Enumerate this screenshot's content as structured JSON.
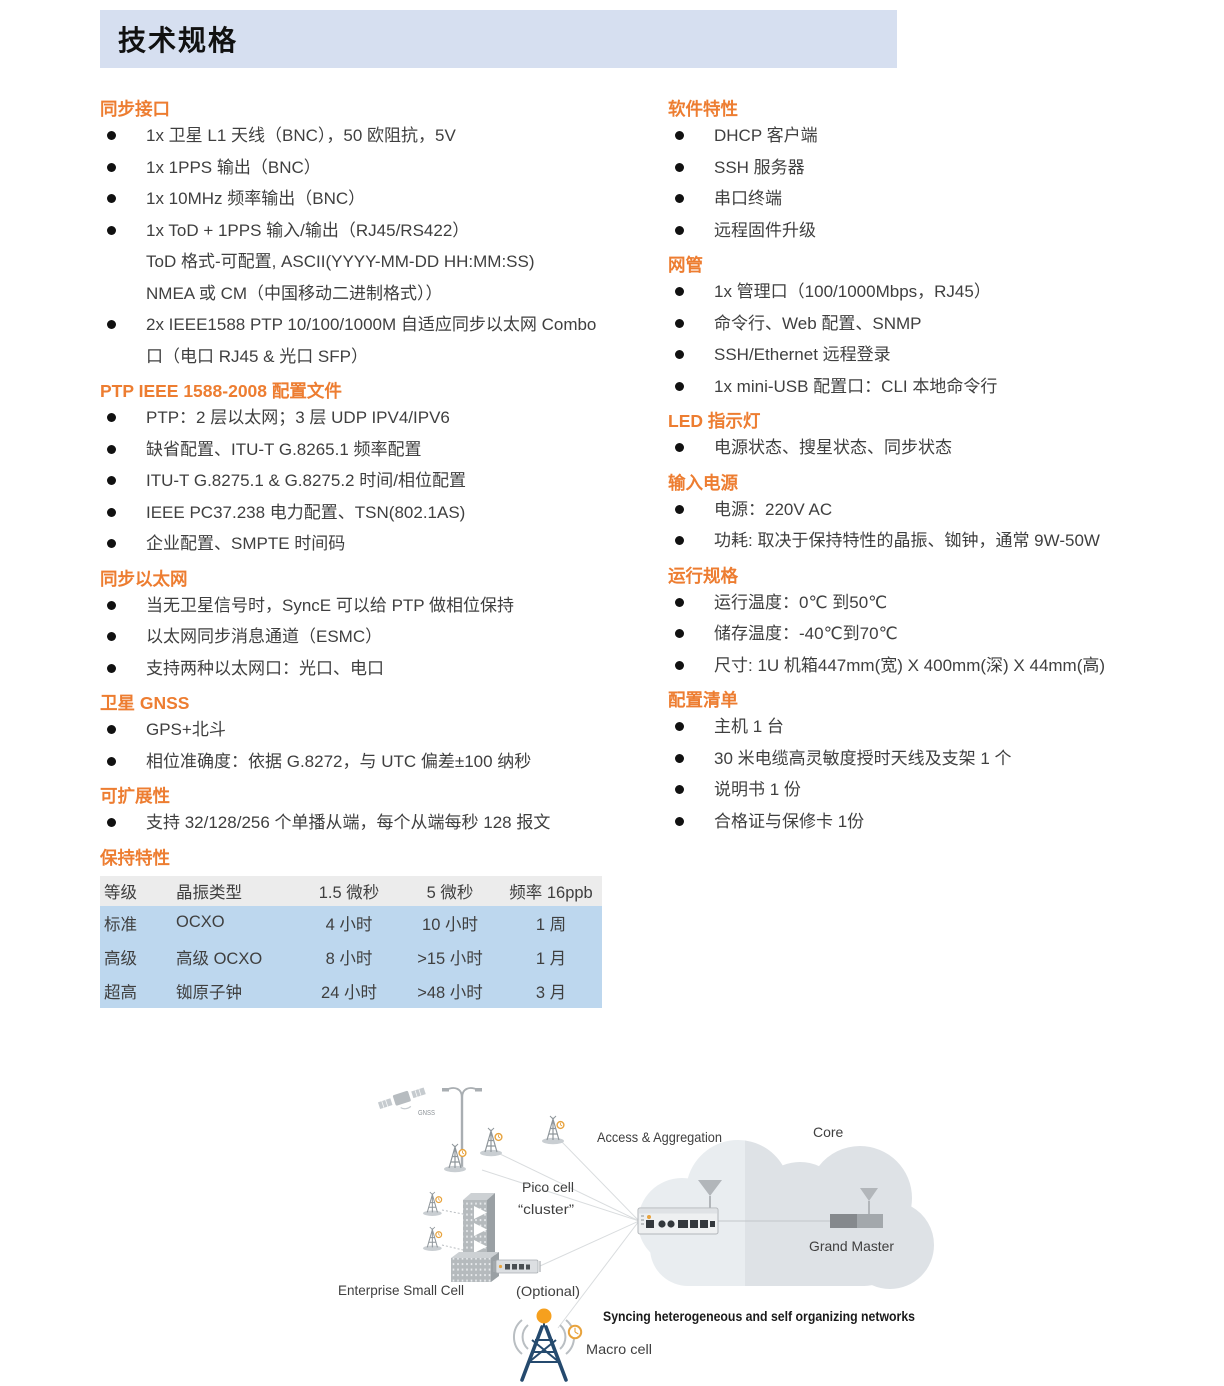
{
  "title": "技术规格",
  "colors": {
    "accent_orange": "#ED7D31",
    "title_bar_bg": "#D6DFF0",
    "table_header_bg": "#ECECEC",
    "table_row_bg": "#BDD7EE",
    "macro_tower_navy": "#254A6E",
    "clock_icon_orange": "#E8A33D"
  },
  "columns": {
    "left": [
      {
        "heading": "同步接口",
        "items": [
          [
            "1x 卫星 L1 天线（BNC），50 欧阻抗，5V"
          ],
          [
            "1x 1PPS  输出（BNC）"
          ],
          [
            "1x 10MHz 频率输出（BNC）"
          ],
          [
            "1x ToD + 1PPS 输入/输出（RJ45/RS422）",
            "ToD 格式-可配置, ASCII(YYYY-MM-DD HH:MM:SS)",
            "NMEA 或 CM（中国移动二进制格式））"
          ],
          [
            "2x IEEE1588 PTP 10/100/1000M 自适应同步以太网 Combo",
            "口（电口 RJ45 &  光口 SFP）"
          ]
        ]
      },
      {
        "heading": "PTP IEEE 1588-2008 配置文件",
        "items": [
          [
            "PTP：2 层以太网；3 层 UDP IPV4/IPV6"
          ],
          [
            "缺省配置、ITU-T G.8265.1 频率配置"
          ],
          [
            "ITU-T G.8275.1 & G.8275.2 时间/相位配置"
          ],
          [
            "IEEE PC37.238 电力配置、TSN(802.1AS)"
          ],
          [
            "企业配置、SMPTE 时间码"
          ]
        ]
      },
      {
        "heading": "同步以太网",
        "items": [
          [
            "当无卫星信号时，SyncE 可以给 PTP 做相位保持"
          ],
          [
            "以太网同步消息通道（ESMC）"
          ],
          [
            "支持两种以太网口：光口、电口"
          ]
        ]
      },
      {
        "heading": "卫星 GNSS",
        "items": [
          [
            "GPS+北斗"
          ],
          [
            "相位准确度：依据 G.8272，与 UTC 偏差±100 纳秒"
          ]
        ]
      },
      {
        "heading": "可扩展性",
        "items": [
          [
            "支持 32/128/256 个单播从端，每个从端每秒 128 报文"
          ]
        ]
      },
      {
        "heading": "保持特性",
        "items": [],
        "table": {
          "headers": [
            "等级",
            "晶振类型",
            "1.5 微秒",
            "5 微秒",
            "频率 16ppb"
          ],
          "rows": [
            [
              "标准",
              "OCXO",
              "4 小时",
              "10 小时",
              "1 周"
            ],
            [
              "高级",
              "高级 OCXO",
              "8 小时",
              ">15 小时",
              "1 月"
            ],
            [
              "超高",
              "铷原子钟",
              "24 小时",
              ">48 小时",
              "3 月"
            ]
          ]
        }
      }
    ],
    "right": [
      {
        "heading": "软件特性",
        "items": [
          [
            "DHCP 客户端"
          ],
          [
            "SSH 服务器"
          ],
          [
            "串口终端"
          ],
          [
            "远程固件升级"
          ]
        ]
      },
      {
        "heading": "网管",
        "items": [
          [
            "1x 管理口（100/1000Mbps，RJ45）"
          ],
          [
            "命令行、Web 配置、SNMP"
          ],
          [
            "SSH/Ethernet 远程登录"
          ],
          [
            "1x mini-USB 配置口：CLI 本地命令行"
          ]
        ]
      },
      {
        "heading": "LED 指示灯",
        "items": [
          [
            "电源状态、搜星状态、同步状态"
          ]
        ]
      },
      {
        "heading": "输入电源",
        "items": [
          [
            "电源：220V AC"
          ],
          [
            "功耗: 取决于保持特性的晶振、铷钟，通常 9W-50W"
          ]
        ]
      },
      {
        "heading": "运行规格",
        "items": [
          [
            "运行温度：0℃ 到50℃"
          ],
          [
            "储存温度：-40℃到70℃"
          ],
          [
            "尺寸: 1U 机箱447mm(宽) X 400mm(深) X 44mm(高)"
          ]
        ]
      },
      {
        "heading": "配置清单",
        "items": [
          [
            "主机 1 台"
          ],
          [
            "30 米电缆高灵敏度授时天线及支架 1 个"
          ],
          [
            "说明书 1 份"
          ],
          [
            "合格证与保修卡 1份"
          ]
        ]
      }
    ]
  },
  "diagram": {
    "labels": {
      "gnss": "GNSS",
      "pico_cell_line1": "Pico cell",
      "pico_cell_line2": "“cluster”",
      "access": "Access & Aggregation",
      "core": "Core",
      "enterprise": "Enterprise Small Cell",
      "optional": "(Optional)",
      "grand_master": "Grand Master",
      "macro_cell": "Macro cell",
      "caption": "Syncing heterogeneous and self organizing networks"
    }
  }
}
